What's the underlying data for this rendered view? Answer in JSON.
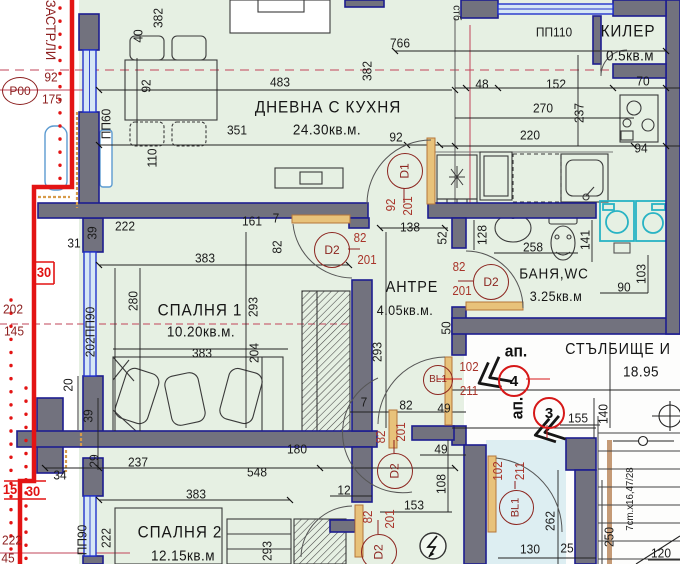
{
  "drawing_title": "ЗАСТР.ЛИ",
  "rooms": {
    "living": {
      "name": "ДНЕВНА С КУХНЯ",
      "area": "24.30кв.м."
    },
    "bedroom1": {
      "name": "СПАЛНЯ 1",
      "area": "10.20кв.м."
    },
    "bedroom2": {
      "name": "СПАЛНЯ 2",
      "area": "12.15кв.м"
    },
    "hall": {
      "name": "АНТРЕ",
      "area": "4.05кв.м."
    },
    "bathroom": {
      "name": "БАНЯ,WC",
      "area": "3.25кв.м"
    },
    "closet": {
      "name": "КИЛЕР",
      "area": "0.5кв.м"
    },
    "staircase": {
      "name": "СТЪЛБИЩЕ И",
      "area": "18.95"
    }
  },
  "colors": {
    "plan_background": "#e6f0e3",
    "wall_fill": "#72727e",
    "wall_outline": "#1d1d8f",
    "window_blue": "#2233cc",
    "building_line_red": "#e31414",
    "annotation_dark_red": "#8c1f1f",
    "door_dim_red": "#a8342a",
    "appliance_cyan": "#28b3c4",
    "door_leaf_orange": "#d9a050",
    "axis_crimson": "#c2455a"
  },
  "labels": [
    {
      "t": "ЗАСТР.ЛИ",
      "x": 51,
      "y": 30,
      "r": 90,
      "c": "axis",
      "s": 14,
      "n": "building-line-label"
    },
    {
      "t": "92",
      "x": 51,
      "y": 77,
      "c": "axis"
    },
    {
      "t": "175",
      "x": 52,
      "y": 99,
      "c": "axis"
    },
    {
      "t": "30",
      "x": 44,
      "y": 272,
      "c": "brred"
    },
    {
      "t": "15",
      "x": 10,
      "y": 489,
      "c": "brred"
    },
    {
      "t": "30",
      "x": 33,
      "y": 491,
      "c": "brred"
    },
    {
      "t": "202",
      "x": 13,
      "y": 309,
      "c": "axis"
    },
    {
      "t": "145",
      "x": 14,
      "y": 331,
      "c": "axis"
    },
    {
      "t": "222",
      "x": 12,
      "y": 540,
      "c": "axis"
    },
    {
      "t": "45",
      "x": 8,
      "y": 558,
      "c": "axis"
    },
    {
      "t": "ПП60",
      "x": 106,
      "y": 124,
      "r": 270,
      "n": "window-tag"
    },
    {
      "t": "110",
      "x": 152,
      "y": 158,
      "r": 270
    },
    {
      "t": "92",
      "x": 146,
      "y": 86,
      "r": 270
    },
    {
      "t": "40",
      "x": 138,
      "y": 36,
      "r": 270
    },
    {
      "t": "382",
      "x": 158,
      "y": 18,
      "r": 270
    },
    {
      "t": "766",
      "x": 400,
      "y": 43
    },
    {
      "t": "483",
      "x": 280,
      "y": 82
    },
    {
      "t": "382",
      "x": 367,
      "y": 71,
      "r": 270
    },
    {
      "t": "351",
      "x": 237,
      "y": 130
    },
    {
      "t": "92",
      "x": 396,
      "y": 137
    },
    {
      "t": "стб",
      "x": 456,
      "y": 13,
      "r": 90,
      "s": 11
    },
    {
      "t": "ПП110",
      "x": 554,
      "y": 32,
      "n": "window-tag"
    },
    {
      "t": "48",
      "x": 482,
      "y": 84
    },
    {
      "t": "152",
      "x": 556,
      "y": 84
    },
    {
      "t": "70",
      "x": 643,
      "y": 81
    },
    {
      "t": "270",
      "x": 543,
      "y": 108
    },
    {
      "t": "237",
      "x": 579,
      "y": 113,
      "r": 270
    },
    {
      "t": "220",
      "x": 530,
      "y": 135
    },
    {
      "t": "94",
      "x": 641,
      "y": 148
    },
    {
      "t": "92",
      "x": 391,
      "y": 205,
      "r": 270,
      "c": "red",
      "n": "door-dim"
    },
    {
      "t": "201",
      "x": 408,
      "y": 206,
      "r": 270,
      "c": "red",
      "n": "door-dim"
    },
    {
      "t": "31",
      "x": 74,
      "y": 243
    },
    {
      "t": "39",
      "x": 92,
      "y": 233,
      "r": 270
    },
    {
      "t": "222",
      "x": 125,
      "y": 226
    },
    {
      "t": "161",
      "x": 252,
      "y": 221
    },
    {
      "t": "7",
      "x": 276,
      "y": 218
    },
    {
      "t": "82",
      "x": 277,
      "y": 247,
      "r": 270
    },
    {
      "t": "138",
      "x": 410,
      "y": 227
    },
    {
      "t": "52",
      "x": 442,
      "y": 238,
      "r": 270
    },
    {
      "t": "82",
      "x": 360,
      "y": 238,
      "c": "red",
      "n": "door-dim"
    },
    {
      "t": "201",
      "x": 367,
      "y": 260,
      "c": "red",
      "n": "door-dim"
    },
    {
      "t": "383",
      "x": 205,
      "y": 258
    },
    {
      "t": "280",
      "x": 133,
      "y": 301,
      "r": 270
    },
    {
      "t": "383",
      "x": 202,
      "y": 353
    },
    {
      "t": "202ПП90",
      "x": 90,
      "y": 332,
      "r": 270,
      "n": "window-tag"
    },
    {
      "t": "293",
      "x": 253,
      "y": 307,
      "r": 270
    },
    {
      "t": "204",
      "x": 254,
      "y": 353,
      "r": 270
    },
    {
      "t": "293",
      "x": 377,
      "y": 352,
      "r": 270
    },
    {
      "t": "50",
      "x": 446,
      "y": 328,
      "r": 270
    },
    {
      "t": "128",
      "x": 482,
      "y": 235,
      "r": 270
    },
    {
      "t": "258",
      "x": 533,
      "y": 247
    },
    {
      "t": "141",
      "x": 585,
      "y": 240,
      "r": 270
    },
    {
      "t": "90",
      "x": 624,
      "y": 287
    },
    {
      "t": "103",
      "x": 641,
      "y": 274,
      "r": 270
    },
    {
      "t": "82",
      "x": 459,
      "y": 267,
      "c": "red",
      "n": "door-dim"
    },
    {
      "t": "201",
      "x": 462,
      "y": 291,
      "c": "red",
      "n": "door-dim"
    },
    {
      "t": "20",
      "x": 68,
      "y": 385,
      "r": 270
    },
    {
      "t": "39",
      "x": 88,
      "y": 416,
      "r": 270
    },
    {
      "t": "29",
      "x": 94,
      "y": 461,
      "r": 270
    },
    {
      "t": "237",
      "x": 138,
      "y": 462
    },
    {
      "t": "34",
      "x": 60,
      "y": 475
    },
    {
      "t": "548",
      "x": 257,
      "y": 472
    },
    {
      "t": "180",
      "x": 297,
      "y": 449
    },
    {
      "t": "383",
      "x": 196,
      "y": 494
    },
    {
      "t": "ПП90",
      "x": 82,
      "y": 540,
      "r": 270,
      "n": "window-tag"
    },
    {
      "t": "222",
      "x": 106,
      "y": 538,
      "r": 270
    },
    {
      "t": "293",
      "x": 267,
      "y": 551,
      "r": 270
    },
    {
      "t": "7",
      "x": 364,
      "y": 402
    },
    {
      "t": "82",
      "x": 406,
      "y": 405
    },
    {
      "t": "49",
      "x": 444,
      "y": 408
    },
    {
      "t": "82",
      "x": 381,
      "y": 437,
      "r": 270,
      "c": "red",
      "n": "door-dim"
    },
    {
      "t": "201",
      "x": 401,
      "y": 432,
      "r": 270,
      "c": "red",
      "n": "door-dim"
    },
    {
      "t": "49",
      "x": 441,
      "y": 449
    },
    {
      "t": "108",
      "x": 441,
      "y": 484,
      "r": 270
    },
    {
      "t": "12",
      "x": 344,
      "y": 490
    },
    {
      "t": "153",
      "x": 414,
      "y": 505
    },
    {
      "t": "82",
      "x": 368,
      "y": 517,
      "r": 270,
      "c": "red",
      "n": "door-dim"
    },
    {
      "t": "201",
      "x": 390,
      "y": 519,
      "r": 270,
      "c": "red",
      "n": "door-dim"
    },
    {
      "t": "102",
      "x": 469,
      "y": 367,
      "c": "red",
      "n": "door-dim"
    },
    {
      "t": "211",
      "x": 469,
      "y": 391,
      "c": "red",
      "n": "door-dim"
    },
    {
      "t": "ап.",
      "x": 516,
      "y": 351,
      "c": "ap",
      "n": "apartment-label"
    },
    {
      "t": "ап.",
      "x": 517,
      "y": 408,
      "r": 270,
      "c": "ap",
      "n": "apartment-label"
    },
    {
      "t": "102",
      "x": 498,
      "y": 471,
      "r": 270,
      "c": "red",
      "n": "door-dim"
    },
    {
      "t": "211",
      "x": 520,
      "y": 471,
      "r": 270,
      "c": "red",
      "n": "door-dim"
    },
    {
      "t": "155",
      "x": 578,
      "y": 418
    },
    {
      "t": "140",
      "x": 603,
      "y": 414,
      "r": 270
    },
    {
      "t": "262",
      "x": 550,
      "y": 521,
      "r": 270
    },
    {
      "t": "130",
      "x": 530,
      "y": 549
    },
    {
      "t": "25",
      "x": 567,
      "y": 548
    },
    {
      "t": "250",
      "x": 609,
      "y": 537,
      "r": 270
    },
    {
      "t": "7cm.x16,47/28",
      "x": 630,
      "y": 499,
      "r": 270,
      "c": "dimS",
      "n": "stair-spec-label"
    },
    {
      "t": "120",
      "x": 661,
      "y": 553
    }
  ],
  "markers": [
    {
      "t": "Р00",
      "x": 19,
      "y": 90,
      "w": 34,
      "h": 26,
      "c": "axis",
      "fs": 12,
      "n": "axis-marker-p00"
    },
    {
      "t": "D1",
      "x": 404,
      "y": 170,
      "w": 34,
      "h": 34,
      "rot": 270,
      "fs": 12,
      "n": "door-tag-d1"
    },
    {
      "t": "D2",
      "x": 331,
      "y": 249,
      "w": 34,
      "h": 34,
      "fs": 12,
      "n": "door-tag-d2-bedroom1"
    },
    {
      "t": "D2",
      "x": 490,
      "y": 281,
      "w": 34,
      "h": 34,
      "fs": 12,
      "n": "door-tag-d2-bathroom"
    },
    {
      "t": "D2",
      "x": 394,
      "y": 470,
      "w": 34,
      "h": 34,
      "rot": 270,
      "fs": 12,
      "n": "door-tag-d2-hall"
    },
    {
      "t": "D2",
      "x": 378,
      "y": 551,
      "w": 34,
      "h": 34,
      "rot": 270,
      "fs": 12,
      "n": "door-tag-d2-bedroom2"
    },
    {
      "t": "BL1",
      "x": 437,
      "y": 379,
      "w": 28,
      "h": 28,
      "fs": 10,
      "n": "door-tag-bl1-entry"
    },
    {
      "t": "BL1",
      "x": 515,
      "y": 506,
      "w": 33,
      "h": 33,
      "rot": 270,
      "fs": 11,
      "n": "door-tag-bl1-vestibule"
    },
    {
      "t": "4",
      "x": 512,
      "y": 379,
      "w": 28,
      "h": 28,
      "c": "apt",
      "fs": 15,
      "n": "apartment-number-4"
    },
    {
      "t": "3",
      "x": 547,
      "y": 411,
      "w": 28,
      "h": 28,
      "c": "apt",
      "fs": 15,
      "n": "apartment-number-3"
    }
  ]
}
